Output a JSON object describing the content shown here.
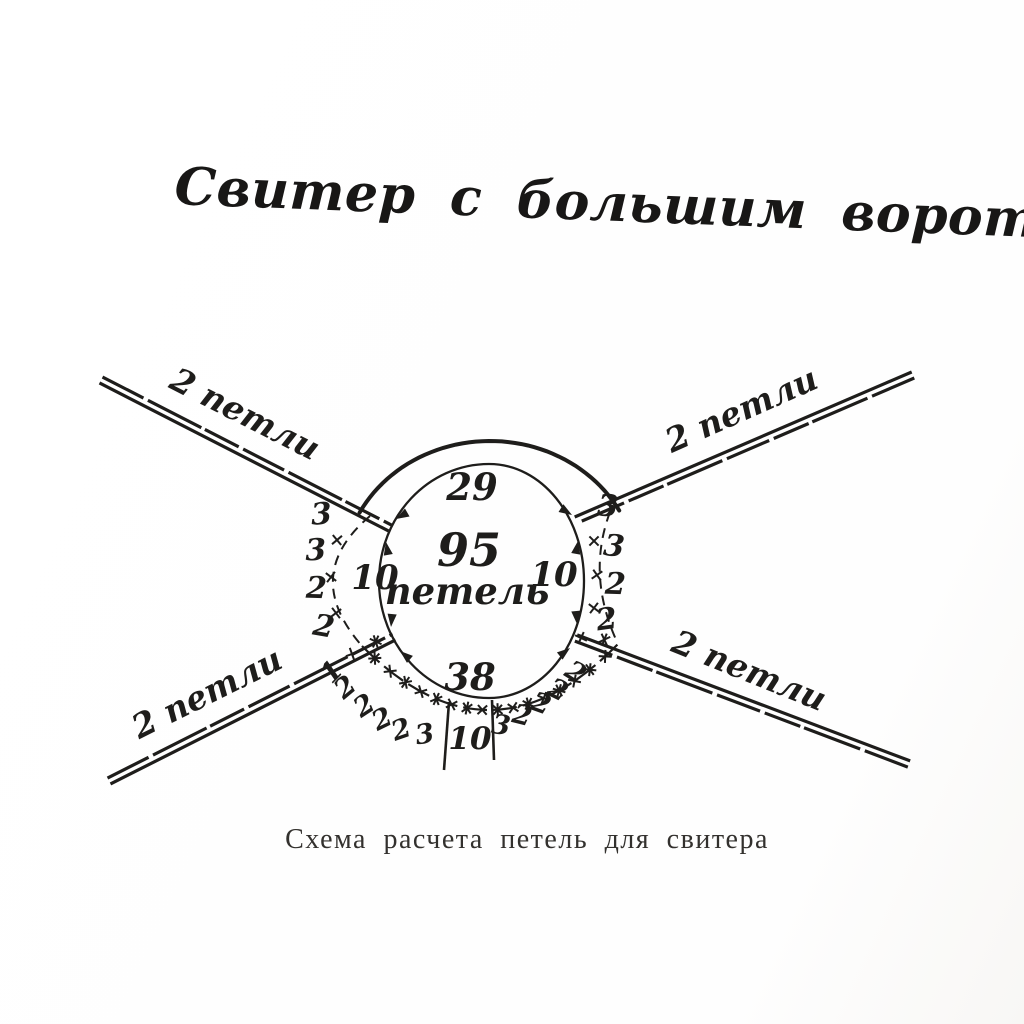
{
  "colors": {
    "ink": "#1e1d1b",
    "paper": "#fefefe"
  },
  "page": {
    "title": "Свитер с большим воротником",
    "caption": "Схема расчета петель для свитера"
  },
  "diagram": {
    "center": {
      "value": "95",
      "unit": "петель"
    },
    "arcs": {
      "top": "29",
      "left": "10",
      "right": "10",
      "bottom": "38",
      "bottom_center": "10"
    },
    "side_decreases": {
      "left": [
        "3",
        "3",
        "2",
        "2"
      ],
      "right": [
        "3",
        "3",
        "2",
        "2"
      ]
    },
    "bottom_decreases": {
      "left": [
        "1",
        "2",
        "2",
        "2",
        "2",
        "3"
      ],
      "right": [
        "3",
        "2",
        "2",
        "2",
        "2"
      ]
    },
    "rays": [
      {
        "position": "top-left",
        "label": "2 петли"
      },
      {
        "position": "top-right",
        "label": "2 петли"
      },
      {
        "position": "bottom-left",
        "label": "2 петли"
      },
      {
        "position": "bottom-right",
        "label": "2 петли"
      }
    ]
  }
}
